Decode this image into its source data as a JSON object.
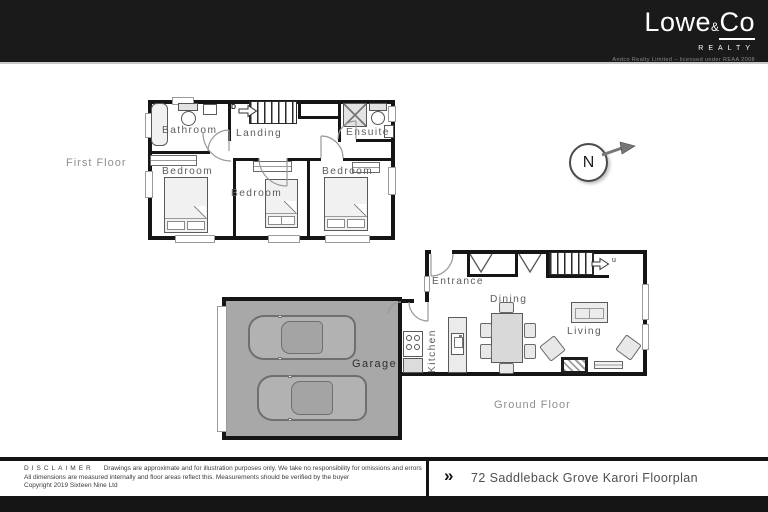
{
  "header": {
    "logo": {
      "word1": "Lowe",
      "amp": "&",
      "word2": "Co",
      "subtitle": "REALTY",
      "tagline": "Andco Realty Limited – licensed under REAA 2008"
    }
  },
  "compass": {
    "label": "N"
  },
  "first_floor": {
    "title": "First Floor",
    "stair_label": "D",
    "rooms": {
      "bathroom": "Bathroom",
      "landing": "Landing",
      "ensuite": "Ensuite",
      "bedroom_left": "Bedroom",
      "bedroom_middle": "Bedroom",
      "bedroom_right": "Bedroom"
    }
  },
  "ground_floor": {
    "title": "Ground Floor",
    "stair_label": "u",
    "rooms": {
      "entrance": "Entrance",
      "dining": "Dining",
      "kitchen": "Kitchen",
      "living": "Living",
      "garage": "Garage"
    }
  },
  "footer": {
    "disclaimer_title": "DISCLAIMER",
    "disclaimer_lines": [
      "Drawings are approximate and for illustration purposes only. We take no responsibility for omissions and errors",
      "All dimensions are measured internally and floor areas reflect this. Measurements should be verified by the buyer",
      "Copyright 2019 Sixteen Nine Ltd"
    ],
    "chevron": "»",
    "plan_title": "72 Saddleback Grove Karori Floorplan"
  },
  "colors": {
    "bar": "#1a1a1a",
    "wall": "#151515",
    "garage_fill": "#a8a8a8"
  }
}
